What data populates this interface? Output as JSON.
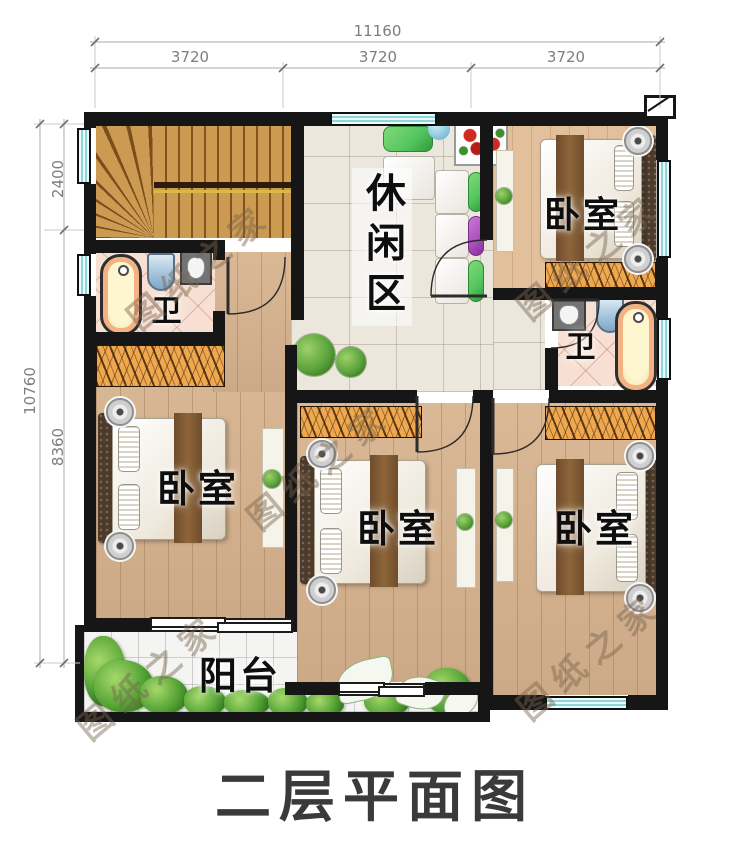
{
  "title": "二层平面图",
  "watermark_text": "图纸之家",
  "dimensions": {
    "top": {
      "total": "11160",
      "segments": [
        "3720",
        "3720",
        "3720"
      ]
    },
    "left": {
      "total": "10760",
      "segments": [
        "2400",
        "8360"
      ]
    }
  },
  "rooms": {
    "leisure": "休闲区",
    "bedroom_tr": "卧室",
    "bedroom_bl": "卧室",
    "bedroom_bm": "卧室",
    "bedroom_br": "卧室",
    "bath_left": "卫",
    "bath_right": "卫",
    "balcony": "阳台"
  },
  "colors": {
    "wall": "#161616",
    "wood_floor": "#d7b38e",
    "wood_floor_light": "#e3c09c",
    "stair_wood": "#c79148",
    "tile_hall": "#ebe7dd",
    "tile_balcony": "#f4f4f2",
    "tile_bath": "#f7e0d3",
    "wardrobe": "#f0a84e",
    "window_fill": "#c9eef0",
    "sofa_green": "#55c45e",
    "sofa_purple": "#a94fb8",
    "flower_red": "#cf2b20",
    "plant_green": "#4e9a35",
    "title_ink": "#3a3a3a",
    "dim_ink": "#7d7d7d"
  }
}
